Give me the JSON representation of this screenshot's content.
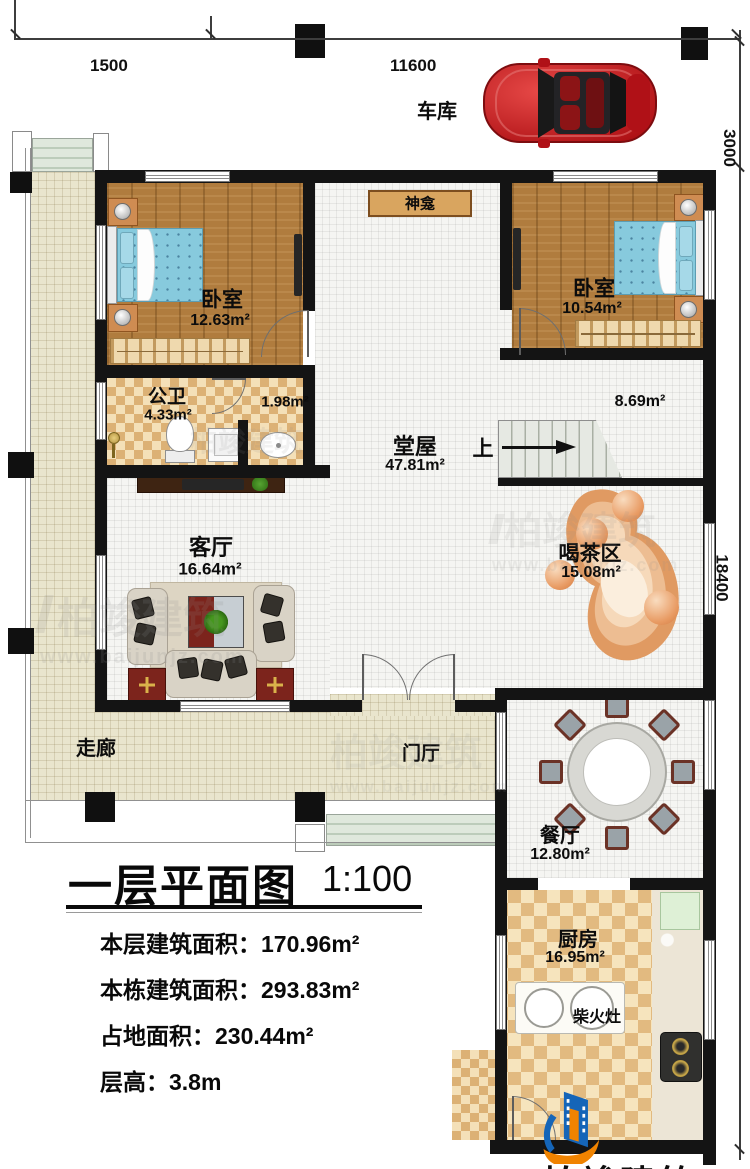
{
  "dimensions": {
    "d1500": "1500",
    "d11600": "11600",
    "d3000": "3000",
    "d18400": "18400"
  },
  "garage": {
    "label": "车库"
  },
  "rooms": {
    "bedroom_left": {
      "name": "卧室",
      "area": "12.63m²"
    },
    "bedroom_right": {
      "name": "卧室",
      "area": "10.54m²"
    },
    "shrine": {
      "name": "神龛"
    },
    "bathroom": {
      "name": "公卫",
      "area": "4.33m²"
    },
    "vanity": {
      "area": "1.98m²"
    },
    "hallway": {
      "area": "8.69m²"
    },
    "hall": {
      "name": "堂屋",
      "area": "47.81m²"
    },
    "stairs_up": {
      "label": "上"
    },
    "living": {
      "name": "客厅",
      "area": "16.64m²"
    },
    "tea": {
      "name": "喝茶区",
      "area": "15.08m²"
    },
    "corridor": {
      "name": "走廊"
    },
    "foyer": {
      "name": "门厅"
    },
    "dining": {
      "name": "餐厅",
      "area": "12.80m²"
    },
    "kitchen": {
      "name": "厨房",
      "area": "16.95m²"
    },
    "wood_stove": {
      "name": "柴火灶"
    }
  },
  "title_block": {
    "title": "一层平面图",
    "scale": "1:100",
    "stats": [
      "本层建筑面积：170.96m²",
      "本栋建筑面积：293.83m²",
      "占地面积：230.44m²",
      "层高：3.8m"
    ]
  },
  "brand": {
    "name": "柏竣建筑",
    "url": "www.baijunjz.com"
  },
  "watermark": {
    "name": "柏竣建筑",
    "url": "www.baijunjz.com"
  }
}
